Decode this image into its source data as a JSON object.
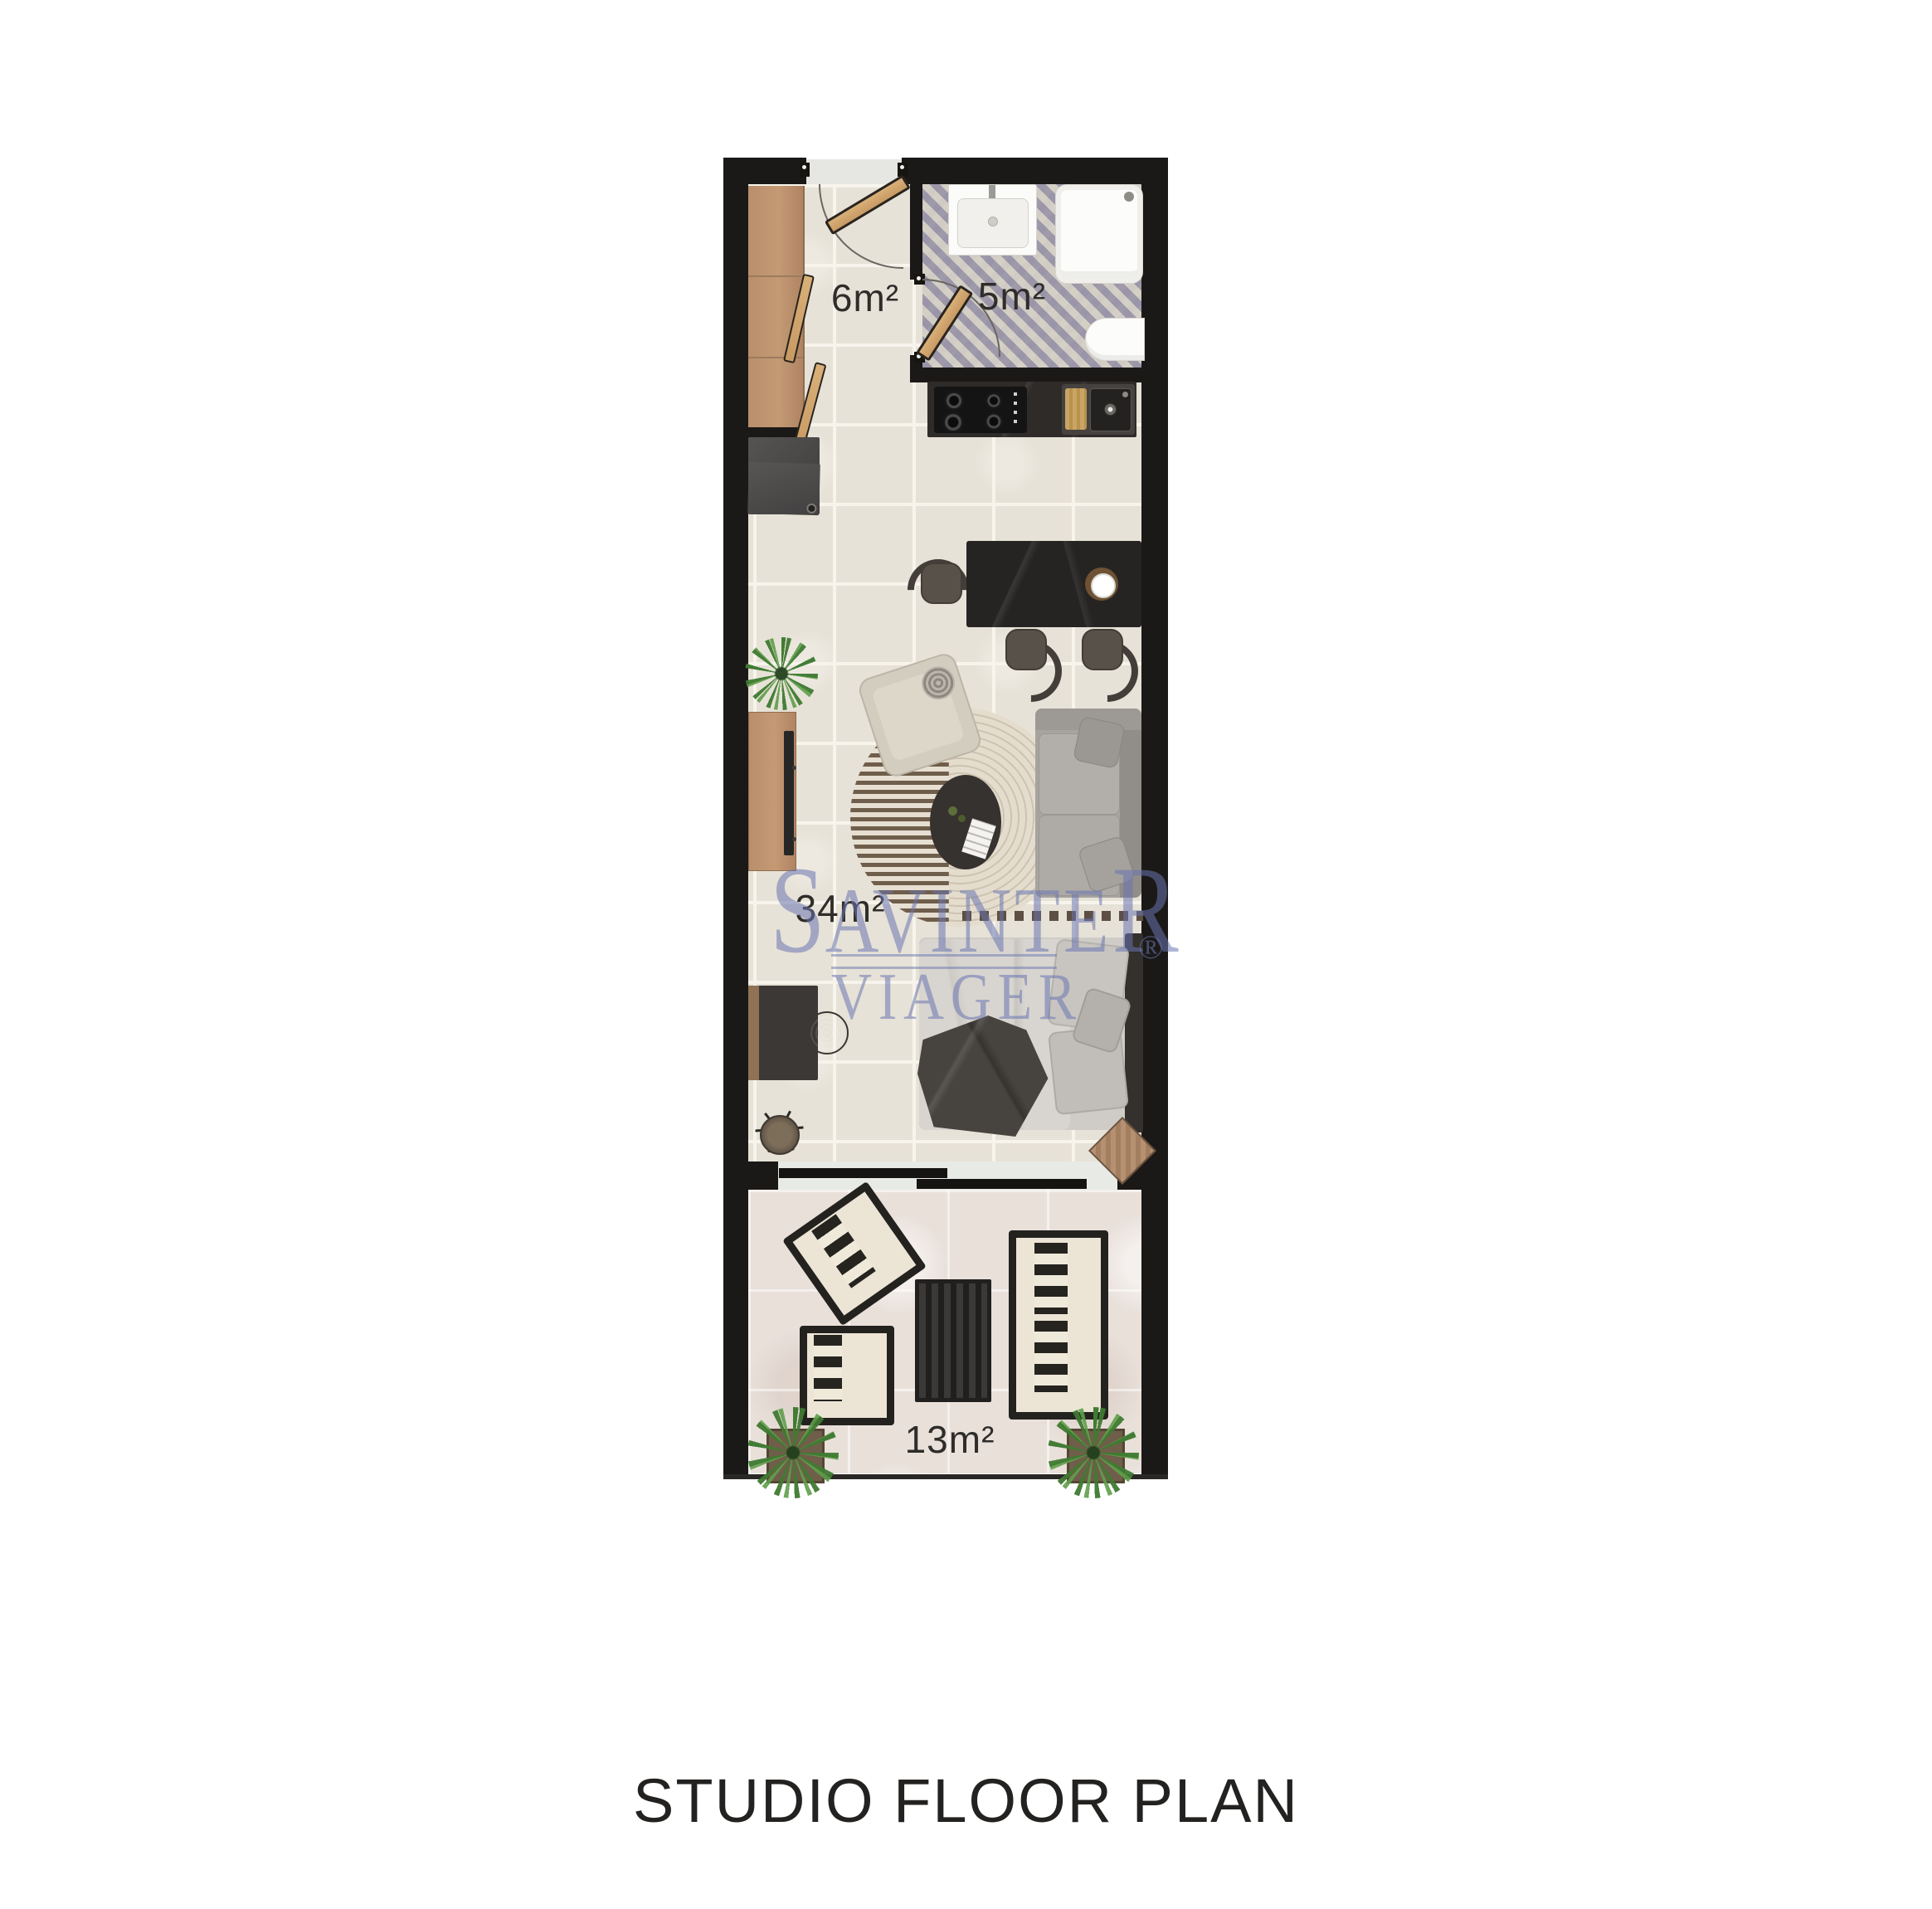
{
  "caption": "STUDIO FLOOR PLAN",
  "watermark": {
    "line1_initial": "S",
    "line1_middle": "AVINTE",
    "line1_final": "R",
    "line2": "VIAGER",
    "registered": "®",
    "color": "#6a75b1"
  },
  "rooms": [
    {
      "name": "entry-hall",
      "area_label": "6m²"
    },
    {
      "name": "bathroom",
      "area_label": "5m²"
    },
    {
      "name": "living-studio",
      "area_label": "34m²"
    },
    {
      "name": "terrace",
      "area_label": "13m²"
    }
  ],
  "colors": {
    "wall": "#1b1917",
    "floor_tile": "#e7e2d7",
    "bathroom_tile_accent": "#9d98ab",
    "terrace_floor": "#e9e0da",
    "wood": "#b98f6c",
    "kitchen_counter": "#2e2b29",
    "sofa": "#a7a39f",
    "label_text": "#2f2d2a"
  }
}
